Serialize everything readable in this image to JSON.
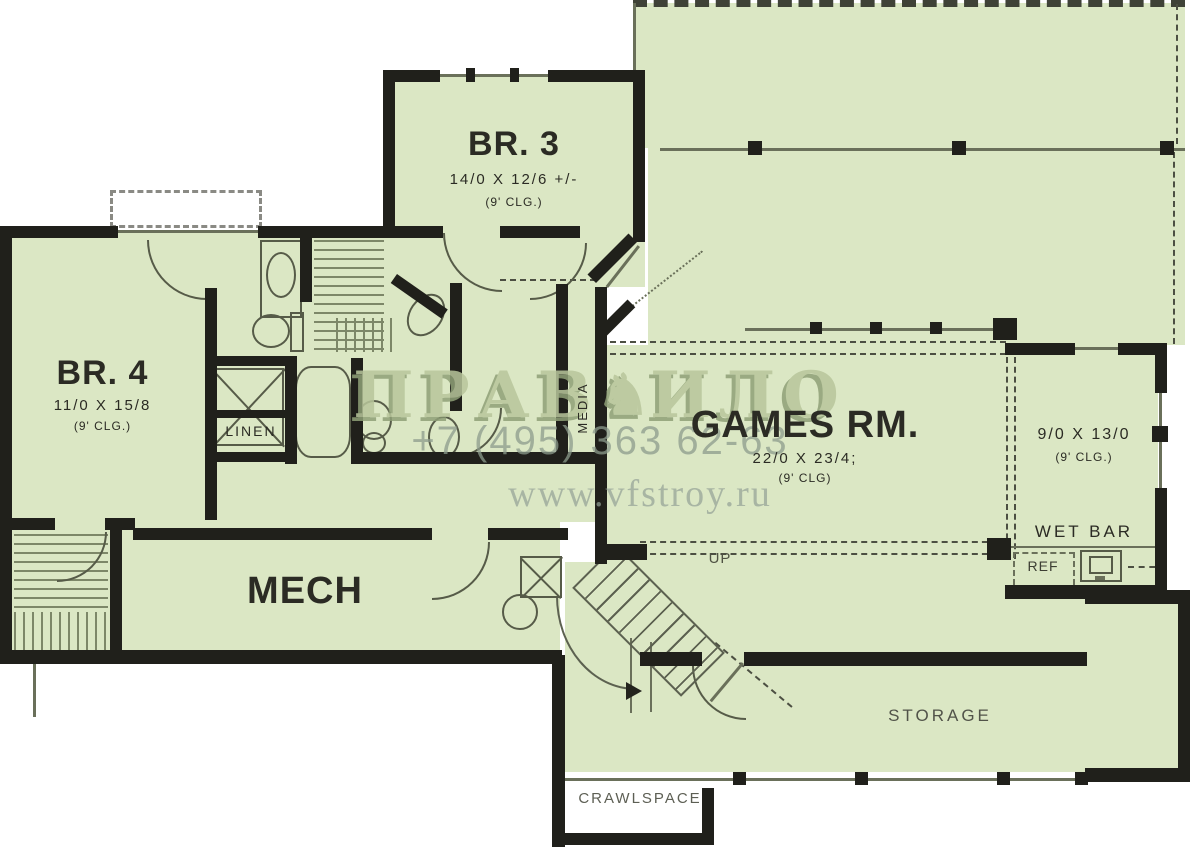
{
  "watermark": {
    "brand_left": "ПРАВ",
    "brand_right": "ИЛО",
    "figure_icon": "gargoyle-figure",
    "phone": "+7 (495) 363 62-63",
    "website": "www.vfstroy.ru"
  },
  "rooms": {
    "br3": {
      "name": "BR. 3",
      "dims": "14/0 X 12/6 +/-",
      "clg": "(9' CLG.)"
    },
    "br4": {
      "name": "BR. 4",
      "dims": "11/0 X 15/8",
      "clg": "(9' CLG.)"
    },
    "games": {
      "name": "GAMES RM.",
      "dims": "22/0 X 23/4;",
      "clg": "(9' CLG)"
    },
    "bonus": {
      "dims": "9/0 X 13/0",
      "clg": "(9' CLG.)"
    },
    "mech": {
      "name": "MECH"
    },
    "storage": {
      "name": "STORAGE"
    },
    "crawlspace": {
      "name": "CRAWLSPACE"
    },
    "linen": {
      "name": "LINEN"
    },
    "media": {
      "name": "MEDIA"
    },
    "wet_bar": {
      "name": "WET BAR"
    },
    "ref": {
      "name": "REF"
    },
    "up": {
      "name": "UP"
    }
  },
  "colors": {
    "floor_fill": "#dbe7c4",
    "wall": "#20201b",
    "thin_line": "#6a705a",
    "label_text": "#2b2b24",
    "watermark_green": "#b8c69b",
    "watermark_grey": "#8d9c8d"
  }
}
